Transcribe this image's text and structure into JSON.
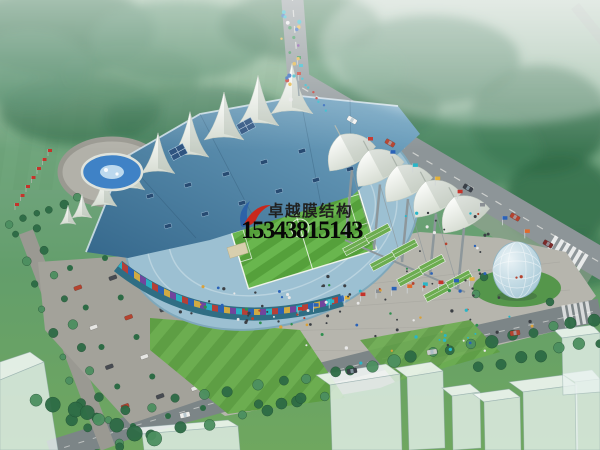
{
  "watermark": {
    "company": "卓越膜结构",
    "phone": "15343815143"
  },
  "colors": {
    "mist": "#a8bfae",
    "forest": "#41805a",
    "forest_dark": "#2f6b47",
    "field": "#639e6b",
    "field_lo": "#55925e",
    "tree": "#2d6b45",
    "tree_hi": "#4c8f60",
    "road": "#8d9598",
    "road_lo": "#7c8587",
    "apron": "#9aa296",
    "plaza": "#b6b5ad",
    "plaza_lo": "#a19f97",
    "roof_a": "#35688c",
    "roof_b": "#74a7c4",
    "seat": "#9cc0d2",
    "membrane": "#f6f7f3",
    "membrane_lo": "#cdd5ca",
    "pitch_a": "#55a03b",
    "pitch_b": "#69b64e",
    "lawn_a": "#6cad50",
    "lawn_b": "#5e9e44",
    "water": "#3f82c6",
    "steel": "#8d979b",
    "glass": "#2f6e84",
    "egg_a": "#eaf3f6",
    "egg_b": "#9cc2d2",
    "wm_text": "#20201f",
    "wm_phone": "#070707",
    "wm_red": "#c9281c",
    "wm_blue": "#2a5fa8"
  }
}
